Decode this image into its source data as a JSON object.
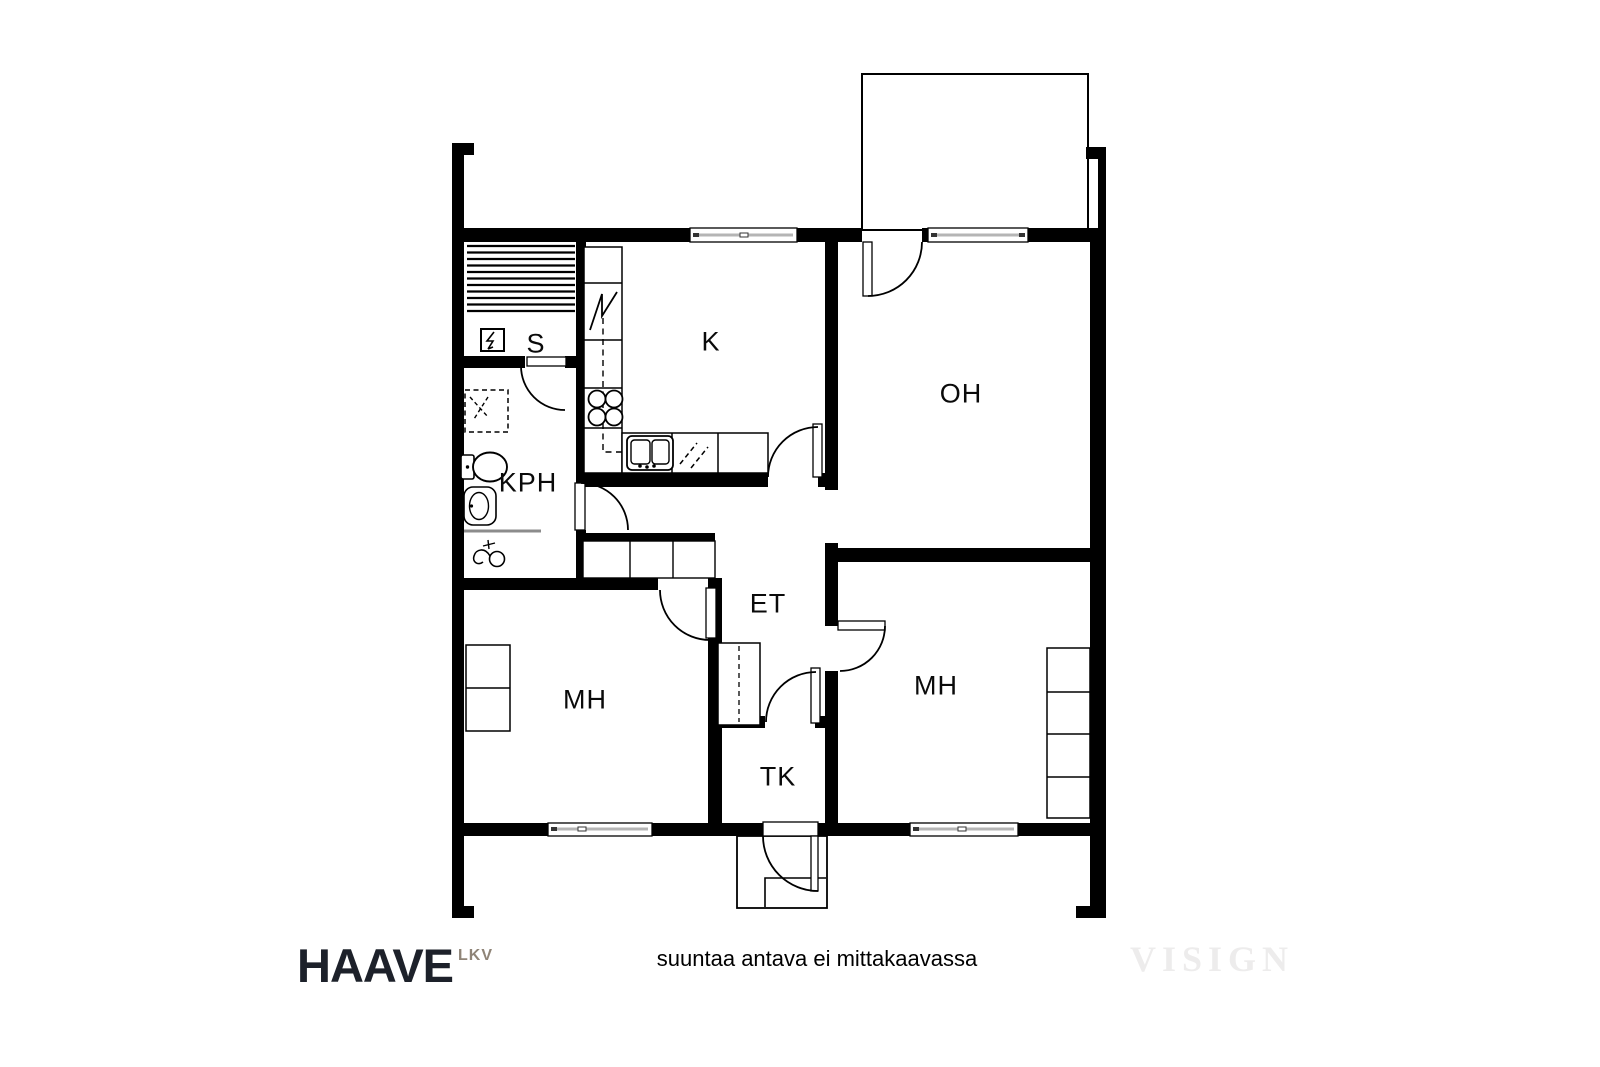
{
  "plan": {
    "rooms": [
      {
        "id": "sauna",
        "label": "S"
      },
      {
        "id": "kitchen",
        "label": "K"
      },
      {
        "id": "living-room",
        "label": "OH"
      },
      {
        "id": "bathroom",
        "label": "KPH"
      },
      {
        "id": "entry-hall",
        "label": "ET"
      },
      {
        "id": "bedroom-left",
        "label": "MH"
      },
      {
        "id": "bedroom-right",
        "label": "MH"
      },
      {
        "id": "walk-in-closet",
        "label": "TK"
      }
    ],
    "icons": {
      "sauna-heater-icon": "square with lightning bolt",
      "sauna-bench-icon": "horizontal slats",
      "fridge-icon": "zigzag mark in cabinet cell",
      "stove-icon": "four burner circles",
      "kitchen-sink-icon": "double basin with faucet dots",
      "dishwasher-icon": "diagonal dashed marks",
      "washing-machine-icon": "dashed square with dashed diagonals",
      "toilet-icon": "tank and oval bowl",
      "bathroom-sink-icon": "rounded basin with oval",
      "shower-mixer-icon": "faucet with round handle",
      "door-swing-icon": "quarter-circle arc",
      "window-icon": "double line in wall"
    },
    "colors": {
      "wall": "#000000",
      "line": "#000000",
      "floor": "#ffffff",
      "window_glass": "#b5b5b5",
      "fixture_gray": "#8c8c8c"
    }
  },
  "footer": {
    "brand": "HAAVE",
    "brand_suffix": "LKV",
    "brand_color": "#1d212a",
    "brand_suffix_color": "#8f8477",
    "disclaimer": "suuntaa antava ei mittakaavassa",
    "watermark": "VISIGN",
    "watermark_color": "#edecec"
  }
}
